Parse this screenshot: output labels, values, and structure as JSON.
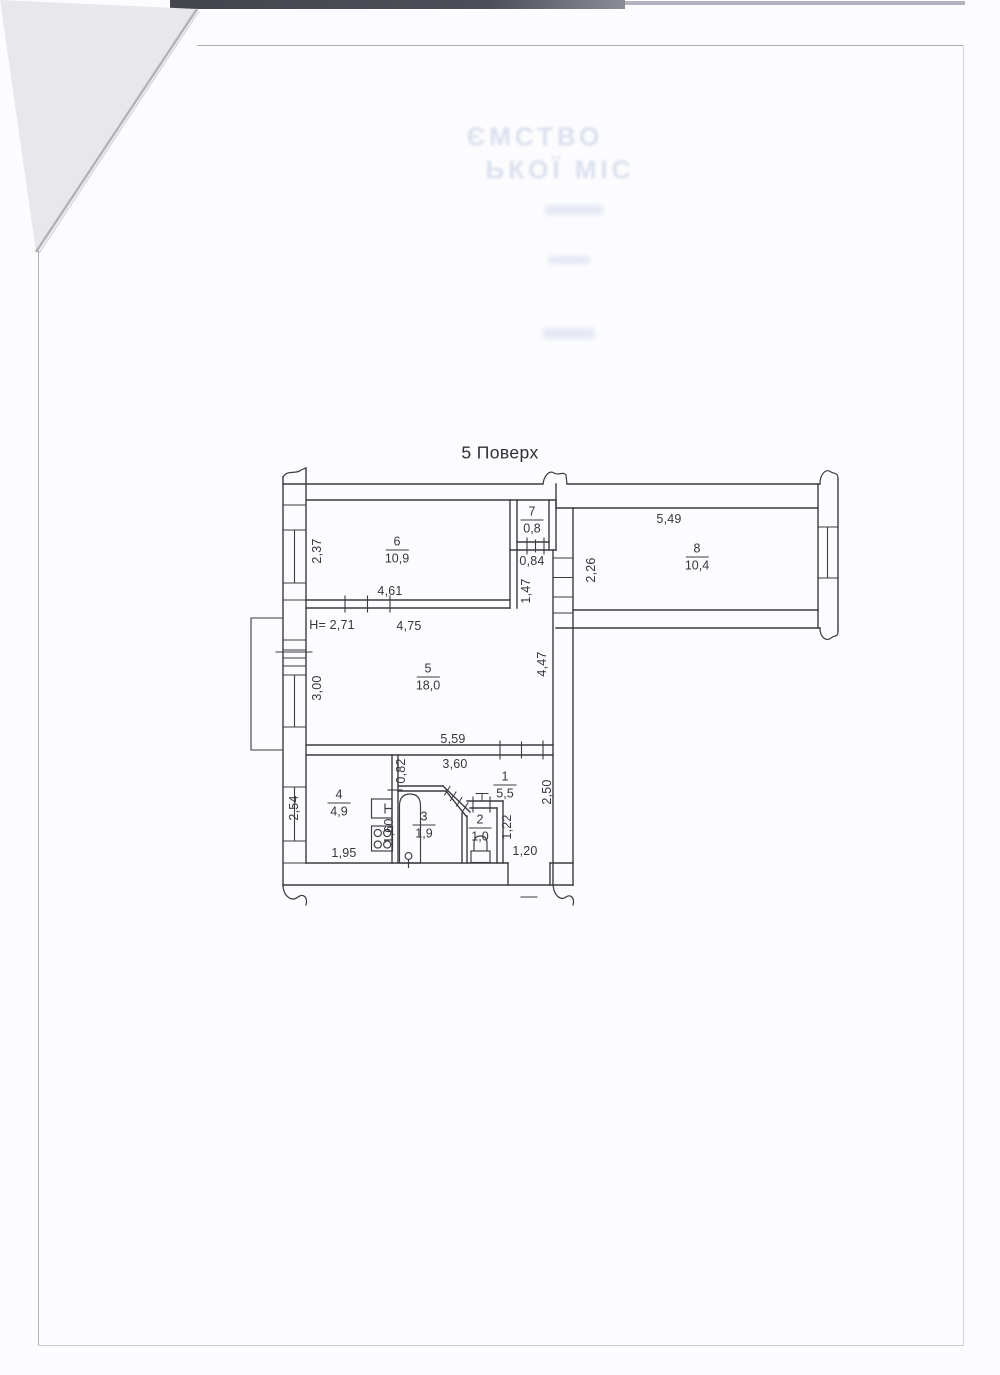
{
  "scan": {
    "title": "5 Поверх",
    "letterhead_line1": "ЄМСТВО",
    "letterhead_line2": "ЬКОЇ МІС"
  },
  "floor_plan": {
    "rooms": [
      {
        "num": "6",
        "area": "10,9",
        "x": 397,
        "y": 550
      },
      {
        "num": "7",
        "area": "0,8",
        "x": 532,
        "y": 520
      },
      {
        "num": "8",
        "area": "10,4",
        "x": 697,
        "y": 557
      },
      {
        "num": "5",
        "area": "18,0",
        "x": 428,
        "y": 677
      },
      {
        "num": "4",
        "area": "4,9",
        "x": 339,
        "y": 803
      },
      {
        "num": "3",
        "area": "1,9",
        "x": 424,
        "y": 825
      },
      {
        "num": "2",
        "area": "1,0",
        "x": 480,
        "y": 828
      },
      {
        "num": "1",
        "area": "5,5",
        "x": 505,
        "y": 785
      }
    ],
    "dimensions": [
      {
        "text": "2,37",
        "x": 317,
        "y": 551,
        "rot": true
      },
      {
        "text": "4,61",
        "x": 390,
        "y": 591,
        "rot": false
      },
      {
        "text": "5,49",
        "x": 669,
        "y": 519,
        "rot": false
      },
      {
        "text": "2,26",
        "x": 591,
        "y": 570,
        "rot": true
      },
      {
        "text": "0,84",
        "x": 532,
        "y": 561,
        "rot": false
      },
      {
        "text": "1,47",
        "x": 526,
        "y": 591,
        "rot": true
      },
      {
        "text": "Н= 2,71",
        "x": 332,
        "y": 625,
        "rot": false
      },
      {
        "text": "4,75",
        "x": 409,
        "y": 626,
        "rot": false
      },
      {
        "text": "3,00",
        "x": 317,
        "y": 688,
        "rot": true
      },
      {
        "text": "4,47",
        "x": 542,
        "y": 664,
        "rot": true
      },
      {
        "text": "5,59",
        "x": 453,
        "y": 739,
        "rot": false
      },
      {
        "text": "3,60",
        "x": 455,
        "y": 764,
        "rot": false
      },
      {
        "text": "0,82",
        "x": 401,
        "y": 771,
        "rot": true
      },
      {
        "text": "2,54",
        "x": 294,
        "y": 808,
        "rot": true
      },
      {
        "text": "1,95",
        "x": 344,
        "y": 853,
        "rot": false
      },
      {
        "text": "1,60",
        "x": 389,
        "y": 831,
        "rot": true
      },
      {
        "text": "1,22",
        "x": 507,
        "y": 827,
        "rot": true
      },
      {
        "text": "2,50",
        "x": 547,
        "y": 792,
        "rot": true
      },
      {
        "text": "1,20",
        "x": 525,
        "y": 851,
        "rot": false
      }
    ]
  }
}
